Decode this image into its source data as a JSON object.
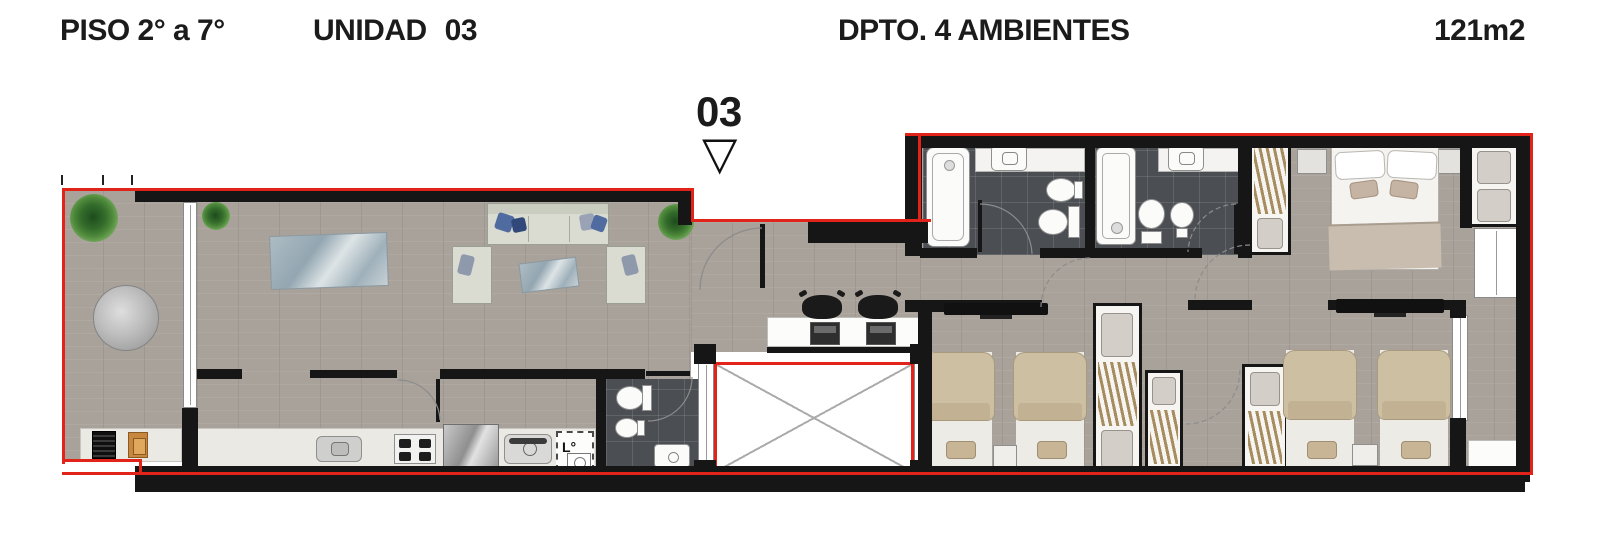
{
  "header": {
    "floor_label": "PISO 2° a 7°",
    "unit_word": "UNIDAD",
    "unit_number": "03",
    "type_label": "DPTO. 4 AMBIENTES",
    "area_label": "121m2"
  },
  "unit_marker": {
    "number": "03",
    "pointer_icon": "▽"
  },
  "kitchen": {
    "laundry_label": "L°"
  },
  "colors": {
    "outline_red": "#e2231a",
    "wall_black": "#161616",
    "floor_gray": "#a8a29a",
    "bathroom_tile": "#4b4e52",
    "counter_white": "#ebe9e4",
    "bed_beige": "#cdbfa2",
    "sofa_gray": "#dadcd2",
    "pillow_blue": "#4f6ba0",
    "glass_blue": "#9fb0ba",
    "plant_green": "#4e893b",
    "closet_wood": "#a78c60"
  }
}
